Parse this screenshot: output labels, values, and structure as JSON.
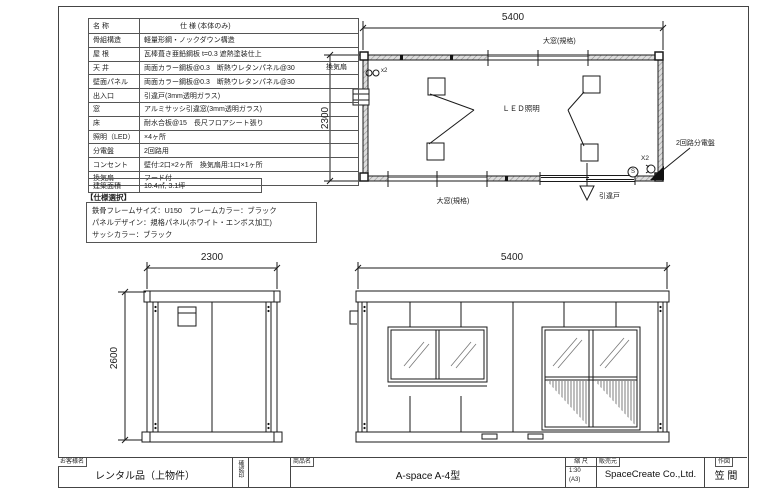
{
  "spec_table": {
    "header": {
      "name": "名 称",
      "value": "仕  様 (本体のみ)"
    },
    "rows": [
      {
        "label": "骨組構造",
        "value": "軽量形鋼・ノックダウン構造"
      },
      {
        "label": "屋 根",
        "value": "瓦棒葺き亜鉛鋼板 t=0.3 遮熱塗装仕上"
      },
      {
        "label": "天 井",
        "value": "両面カラー鋼板@0.3　断熱ウレタンパネル@30"
      },
      {
        "label": "壁面パネル",
        "value": "両面カラー鋼板@0.3　断熱ウレタンパネル@30"
      },
      {
        "label": "出入口",
        "value": "引違戸(3mm透明ガラス)"
      },
      {
        "label": "窓",
        "value": "アルミサッシ引違窓(3mm透明ガラス)"
      },
      {
        "label": "床",
        "value": "耐水合板@15　長尺フロアシート張り"
      },
      {
        "label": "照明（LED）",
        "value": "×4ヶ所"
      },
      {
        "label": "分電盤",
        "value": "2回路用"
      },
      {
        "label": "コンセント",
        "value": "壁付:2口×2ヶ所　換気扇用:1口×1ヶ所"
      },
      {
        "label": "換気扇",
        "value": "フード付"
      }
    ],
    "area_row": {
      "label": "建築面積",
      "value": "10.4㎡, 3.1坪"
    }
  },
  "options": {
    "title": "【仕様選択】",
    "lines": [
      "鉄骨フレームサイズ：U150　フレームカラー：ブラック",
      "パネルデザイン：規格パネル(ホワイト・エンボス加工)",
      "サッシカラー：ブラック"
    ]
  },
  "plan": {
    "dim_width": "5400",
    "dim_height": "2300",
    "label_window_top": "大窓(規格)",
    "label_window_bottom": "大窓(規格)",
    "label_fan": "換気扇",
    "label_fan_count": "x2",
    "label_led": "ＬＥＤ照明",
    "label_door": "引違戸",
    "label_panel": "2回路分電盤",
    "label_outlet_count": "X2",
    "switch_mark": "S"
  },
  "elev_side": {
    "dim_width": "2300",
    "dim_height": "2600"
  },
  "elev_front": {
    "dim_width": "5400"
  },
  "title_block": {
    "customer_label": "お客様名",
    "customer": "レンタル品（上物件）",
    "stamp_label": "確認印",
    "product_label": "商品名",
    "product": "A-space A-4型",
    "scale_label": "縮 尺",
    "scale": "1:30",
    "scale_paper": "(A3)",
    "seller_label": "販売元",
    "seller": "SpaceCreate Co.,Ltd.",
    "author_label": "作図",
    "author": "笠 間"
  }
}
